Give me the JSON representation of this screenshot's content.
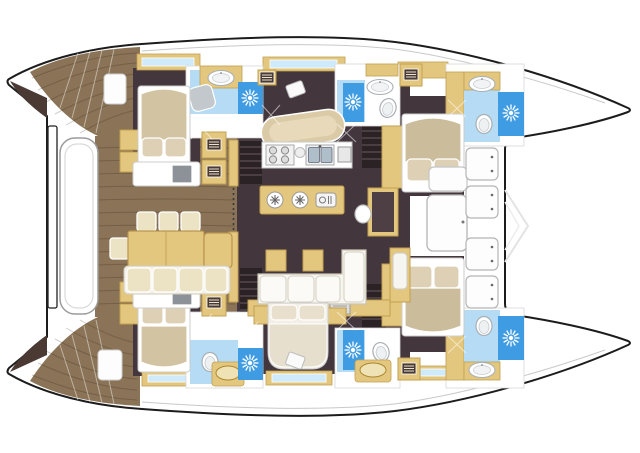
{
  "meta": {
    "title": "Catamaran yacht deck plan",
    "type": "floor-plan",
    "view": "top-down",
    "orientation": "bow-right"
  },
  "colors": {
    "outline": "#1c1c1c",
    "hull_white": "#ffffff",
    "teak": "#8a7356",
    "wedge": "#4a3a33",
    "dark_floor": "#43363c",
    "stair_dark": "#2b2225",
    "stair_line": "#6b5a5e",
    "joinery": "#e4c77e",
    "joinery_edge": "#c2a050",
    "cream": "#ece3c4",
    "cushion_white": "#f6f5f0",
    "duvet": "#d2c3a2",
    "pillow": "#ddd0b5",
    "bed_sheet": "#f2efe6",
    "bath_floor": "#b5dcf4",
    "shower_blue": "#3f9ce2",
    "window_blue": "#cfeafa",
    "fixture_gray": "#aab0b5",
    "fixture_fill": "#c3c8cc",
    "sink_dark": "#8d9298",
    "basin_gray": "#aebfca",
    "wood_top": "#4e3f45",
    "panel_white": "#fdfdfd"
  },
  "glyphs": {
    "shower": "sunburst-icon",
    "refrigeration": "snowflake-icon",
    "locker": "vent-grille-icon",
    "toilet": "toilet-icon",
    "sink": "sink-icon"
  },
  "areas": {
    "hull": {
      "label": "Catamaran twin-hull silhouette"
    },
    "cockpit": {
      "label": "Aft cockpit with dining table and bench"
    },
    "transom_port": {
      "label": "Port transom steps"
    },
    "transom_stbd": {
      "label": "Starboard transom steps"
    },
    "dinghy": {
      "label": "Dinghy stowed across the stern"
    },
    "salon": {
      "label": "Salon on bridge deck"
    },
    "galley": {
      "label": "Galley with stove, double sink and fridge island"
    },
    "nav": {
      "label": "Navigation desk with stool"
    },
    "foredeck": {
      "label": "Forward cockpit with seat pads and door"
    },
    "trampoline": {
      "label": "Bow area between hulls"
    },
    "port_aft_cabin": {
      "label": "Port aft cabin with double berth"
    },
    "port_aft_head": {
      "label": "Port aft bathroom with shower"
    },
    "port_mid_head": {
      "label": "Port mid bathroom with shower"
    },
    "port_fwd_cabin": {
      "label": "Port forward cabin with double berth"
    },
    "port_fwd_head": {
      "label": "Port forward bathroom with shower"
    },
    "stbd_aft_cabin": {
      "label": "Starboard aft cabin with double berth"
    },
    "stbd_aft_head": {
      "label": "Starboard aft bathroom with shower"
    },
    "stbd_mid_head": {
      "label": "Starboard mid bathroom with shower"
    },
    "stbd_fwd_cabin": {
      "label": "Starboard forward cabin with double berth"
    },
    "stbd_fwd_head": {
      "label": "Starboard forward bathroom with shower"
    },
    "center_aft_cabin": {
      "label": "Central aft cabin berth"
    }
  },
  "inventory": {
    "double_berths": 5,
    "bathrooms": 6,
    "showers": 6,
    "companionway_stairs": 4,
    "stove_burners": 4,
    "galley_sink_basins": 2,
    "fridge_drawers": 2,
    "cockpit_chairs": 4,
    "cockpit_bench_cushions": 4,
    "foredeck_seat_pads": 4,
    "window_strips": 6
  }
}
